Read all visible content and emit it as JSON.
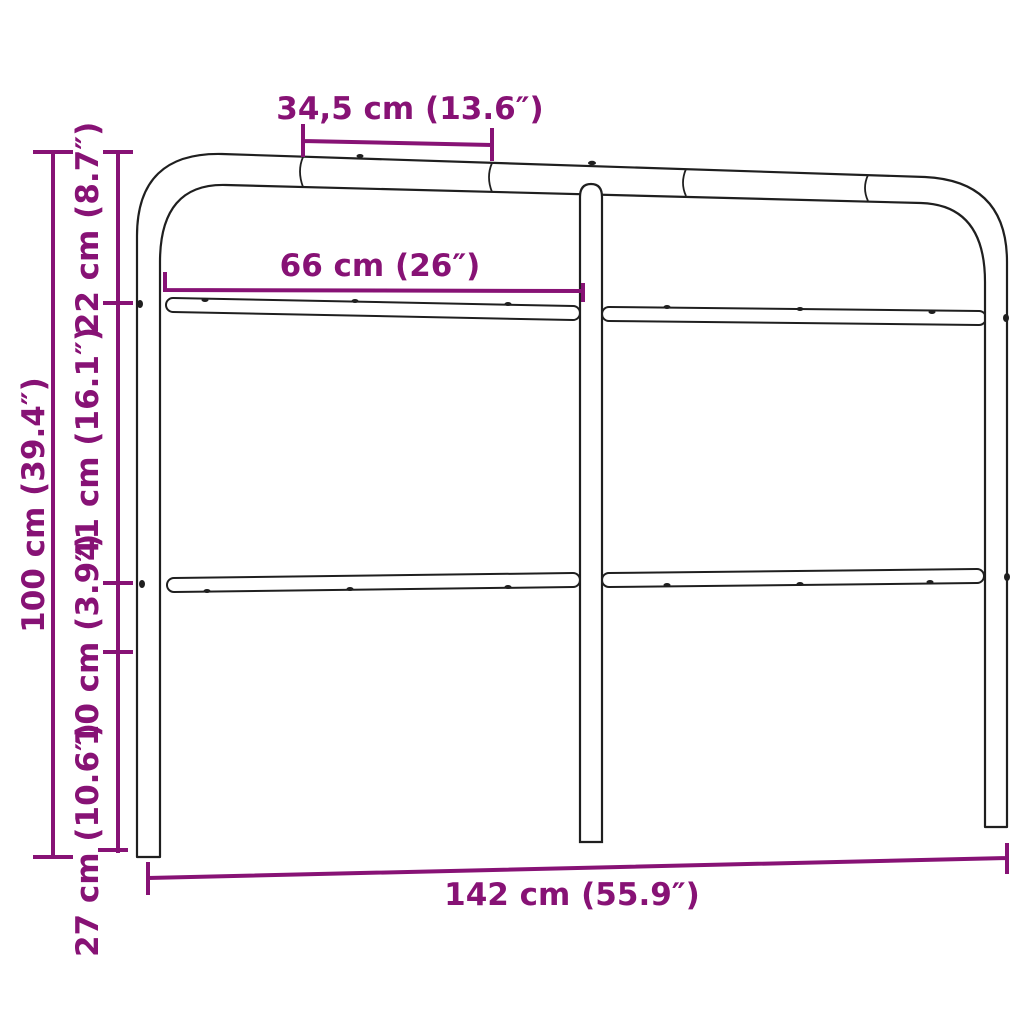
{
  "diagram": {
    "subject": "metal headboard dimension drawing",
    "background_color": "#FFFFFF",
    "outline_color": "#1F1F1F",
    "dimension_color": "#871275",
    "labels": {
      "top_segment_width": "34,5 cm (13.6″)",
      "panel_width": "66 cm (26″)",
      "total_width": "142 cm (55.9″)",
      "total_height": "100 cm (39.4″)",
      "top_to_upper_rail": "22 cm (8.7″)",
      "upper_to_lower_rail": "41 cm (16.1″)",
      "lower_rail_gap": "10 cm (3.9″)",
      "leg_height": "27 cm (10.6″)"
    }
  }
}
